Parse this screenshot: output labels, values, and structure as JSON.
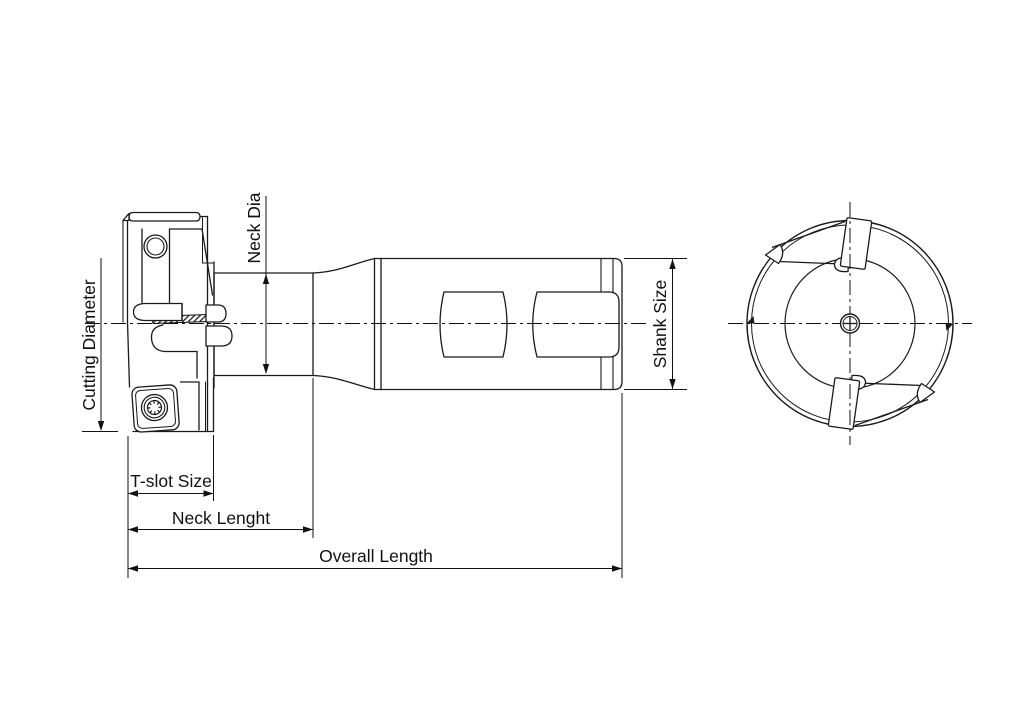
{
  "labels": {
    "cutting_diameter": "Cutting Diameter",
    "neck_dia": "Neck Dia",
    "shank_size": "Shank Size",
    "t_slot_size": "T-slot Size",
    "neck_length": "Neck Lenght",
    "overall_length": "Overall Length"
  },
  "colors": {
    "line": "#1a1a1a",
    "dimension": "#111111",
    "background": "#ffffff"
  }
}
